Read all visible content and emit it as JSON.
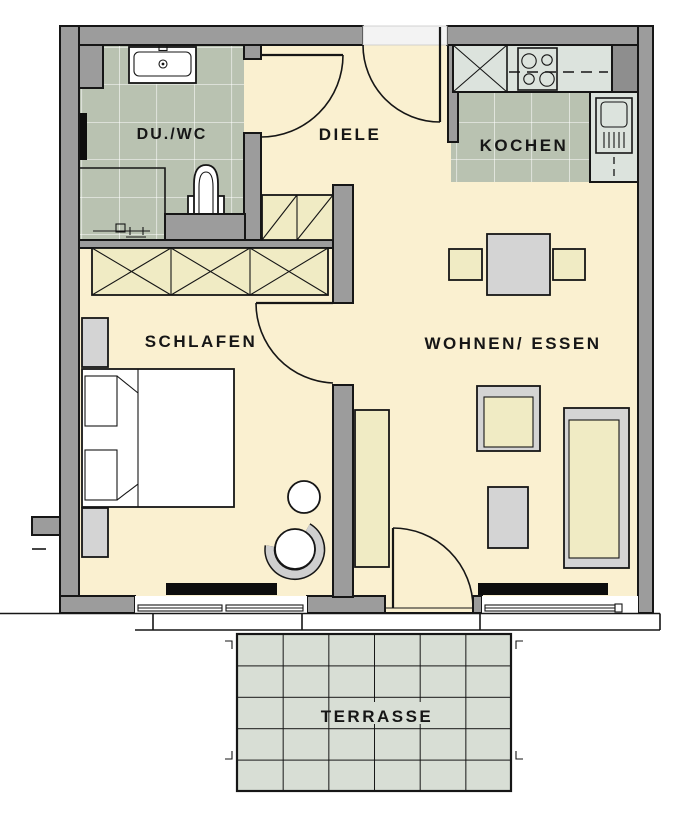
{
  "plan": {
    "type": "apartment-floor-plan",
    "rooms": {
      "duwc": {
        "label": "DU./WC"
      },
      "diele": {
        "label": "DIELE"
      },
      "kochen": {
        "label": "KOCHEN"
      },
      "schlafen": {
        "label": "SCHLAFEN"
      },
      "wohnen": {
        "label": "WOHNEN/ ESSEN"
      },
      "terrasse": {
        "label": "TERRASSE"
      }
    },
    "furniture": [
      "washbasin",
      "toilet",
      "shower",
      "radiator",
      "kitchen-counter",
      "stove",
      "kitchen-sink",
      "wardrobe",
      "hall-cabinet",
      "double-bed",
      "nightstands",
      "dining-table",
      "dining-chairs",
      "sofa",
      "armchair",
      "coffee-table",
      "sideboard",
      "stool",
      "tub-chair"
    ],
    "openings": [
      "entrance-door",
      "bath-door",
      "bedroom-door",
      "terrace-door",
      "bedroom-window",
      "living-window"
    ]
  },
  "colors": {
    "wall": "#9c9c9c",
    "wall_dark": "#8e8e8e",
    "floor": "#faf0d0",
    "bath_tile": "#b9c2b1",
    "counter": "#dce3dd",
    "terrace_tile": "#d8ded5",
    "furniture_cream": "#f0ebc4",
    "furniture_gray": "#d4d4d4",
    "line": "#161616"
  }
}
